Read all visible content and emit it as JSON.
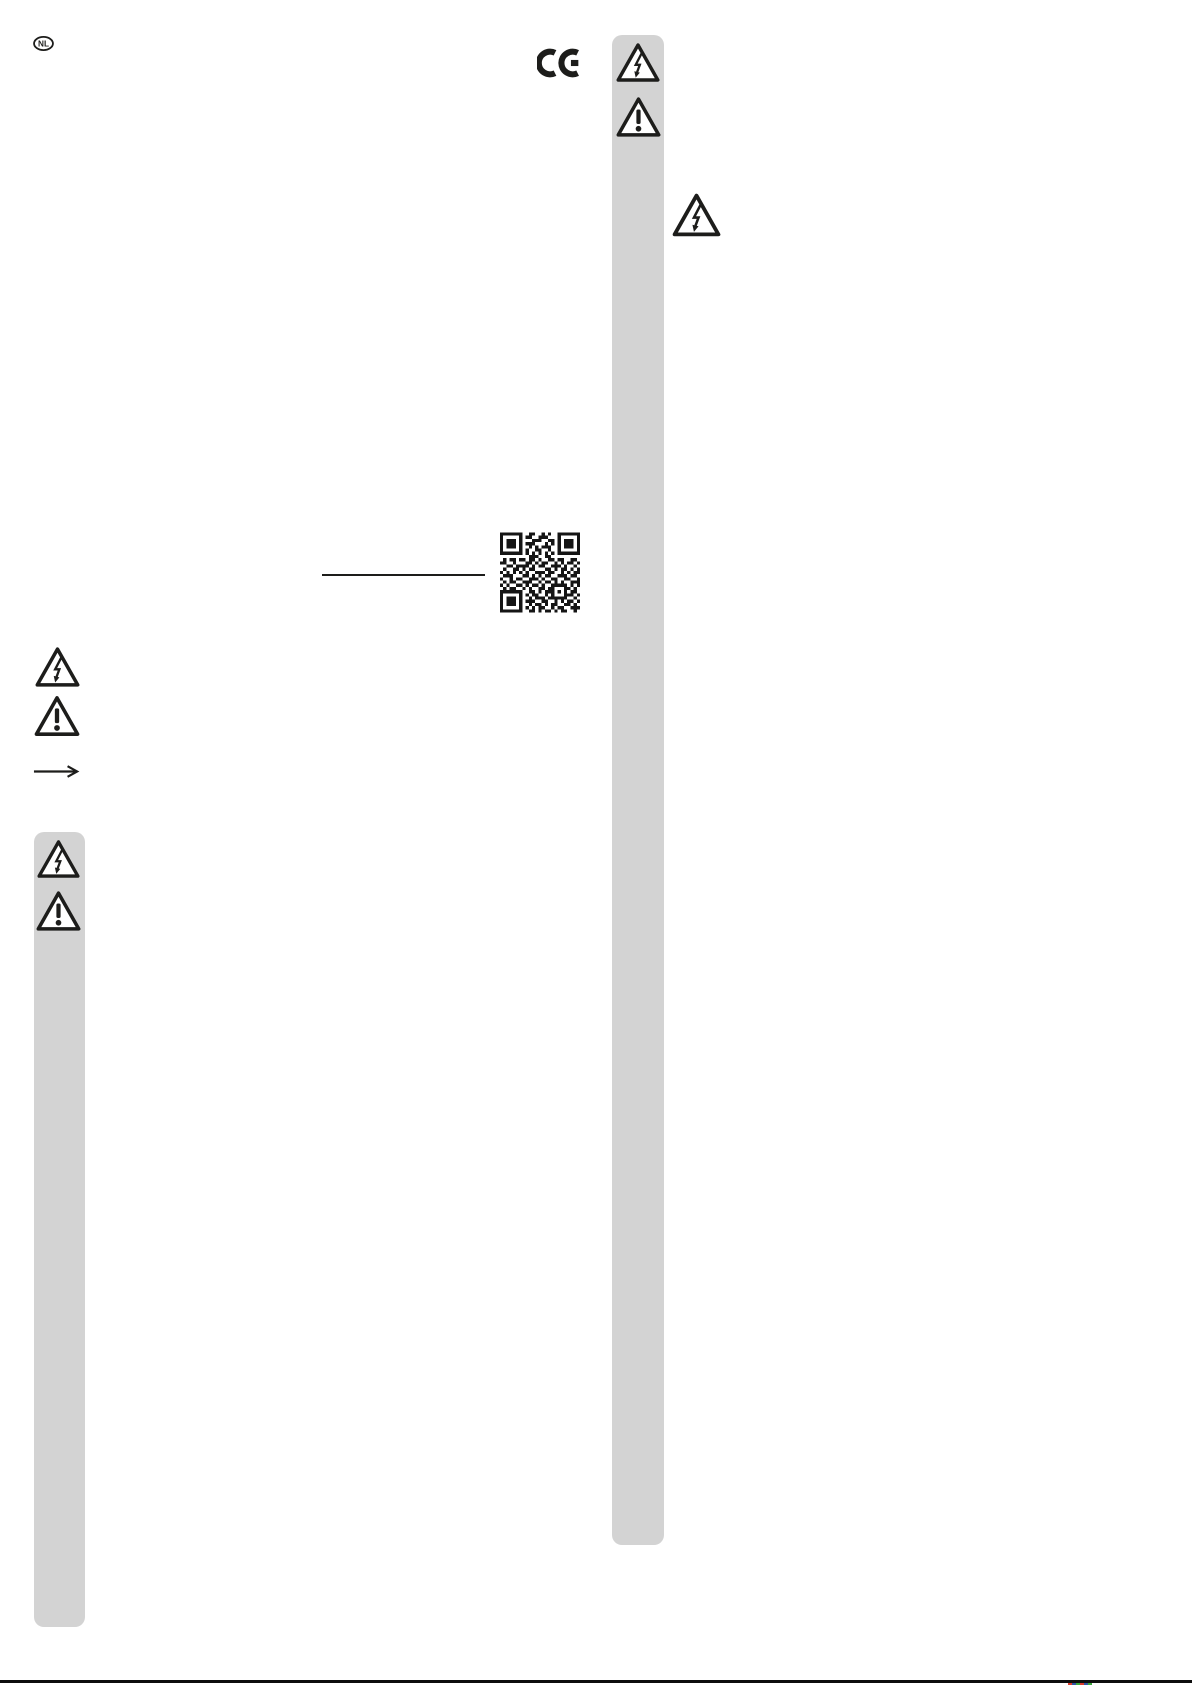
{
  "page": {
    "type": "instruction-manual-page",
    "language_badge": "NL"
  },
  "colors": {
    "bar_gray": "#d3d3d3",
    "print_black": "#1d1d1b",
    "registration_marks": [
      "#d93a2b",
      "#3053a3",
      "#3aa63a"
    ]
  },
  "icons": {
    "ce_mark": "ce-conformity-mark",
    "high_voltage": "high-voltage-warning-triangle",
    "warning": "general-warning-triangle",
    "arrow": "right-arrow",
    "qr_code": "qr-code"
  },
  "qr_matrix": [
    "1111111001100101001111111",
    "1000001011001110001000001",
    "1011101000111001101011101",
    "1011101011100010101011101",
    "1011101001010111001011101",
    "1000001010011001001000001",
    "1111111010101010101111111",
    "0000000001110011000000000",
    "0101101101101001101100110",
    "1100100011010110010101101",
    "0011011110101100111010010",
    "0100110101100011010110101",
    "1010101010011101100101011",
    "0111000110101011001110110",
    "1001011001110100110011001",
    "0101100111001011010100111",
    "1010011010110100111110101",
    "0101100101001101100011010",
    "1111111001101011101010110",
    "1000001010110010100011101",
    "1011101001011101111110010",
    "1011101011100110010101101",
    "1011101001011010110011010",
    "1000001010101100101100111",
    "1111111001101011010110010"
  ]
}
